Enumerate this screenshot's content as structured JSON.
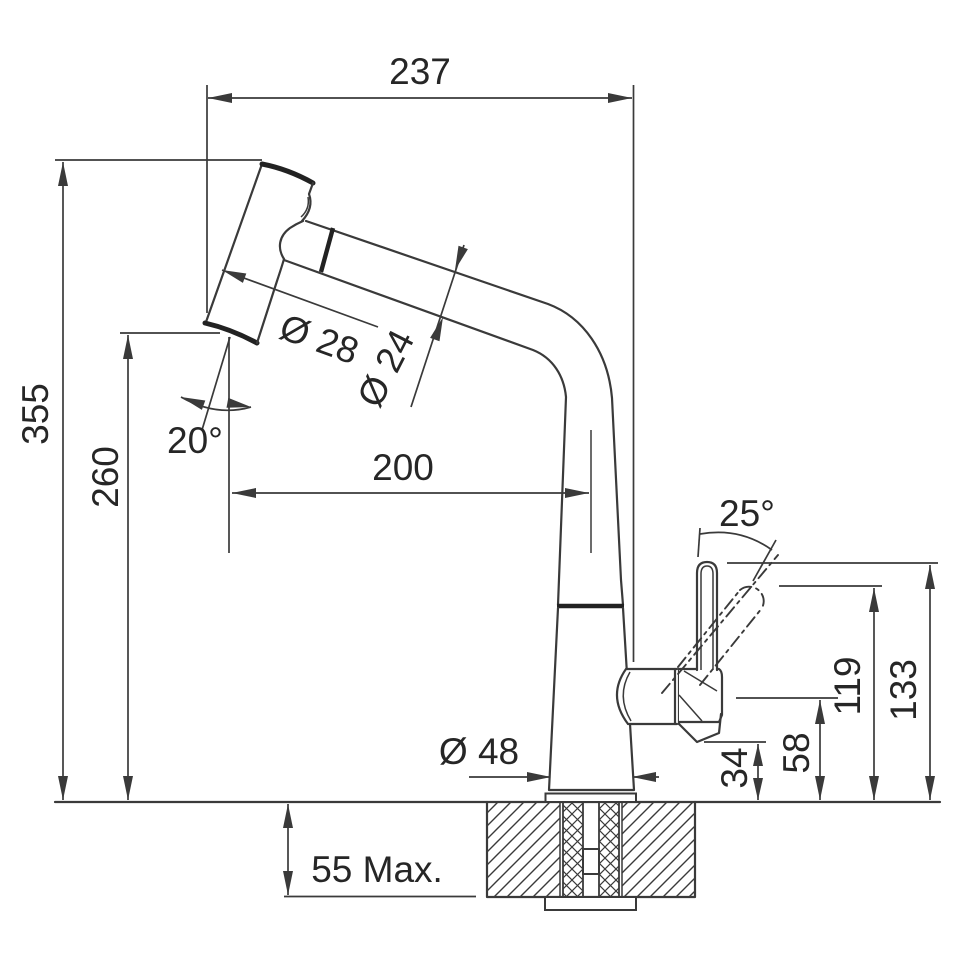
{
  "drawing": {
    "title": "Pull-out kitchen faucet installation dimension drawing",
    "units": "mm",
    "colors": {
      "line": "#3a3a3a",
      "text": "#262626",
      "bg": "#ffffff"
    },
    "labels": {
      "spout_reach": "237",
      "overall_height": "355",
      "outlet_height": "260",
      "head_angle": "20°",
      "head_diameter": "Ø 28",
      "spout_diameter": "Ø 24",
      "horizontal_reach": "200",
      "lever_angle": "25°",
      "lever_tilted_height": "119",
      "lever_height": "133",
      "valve_height": "58",
      "body_height": "34",
      "base_diameter": "Ø 48",
      "counter_thickness": "55 Max."
    }
  }
}
